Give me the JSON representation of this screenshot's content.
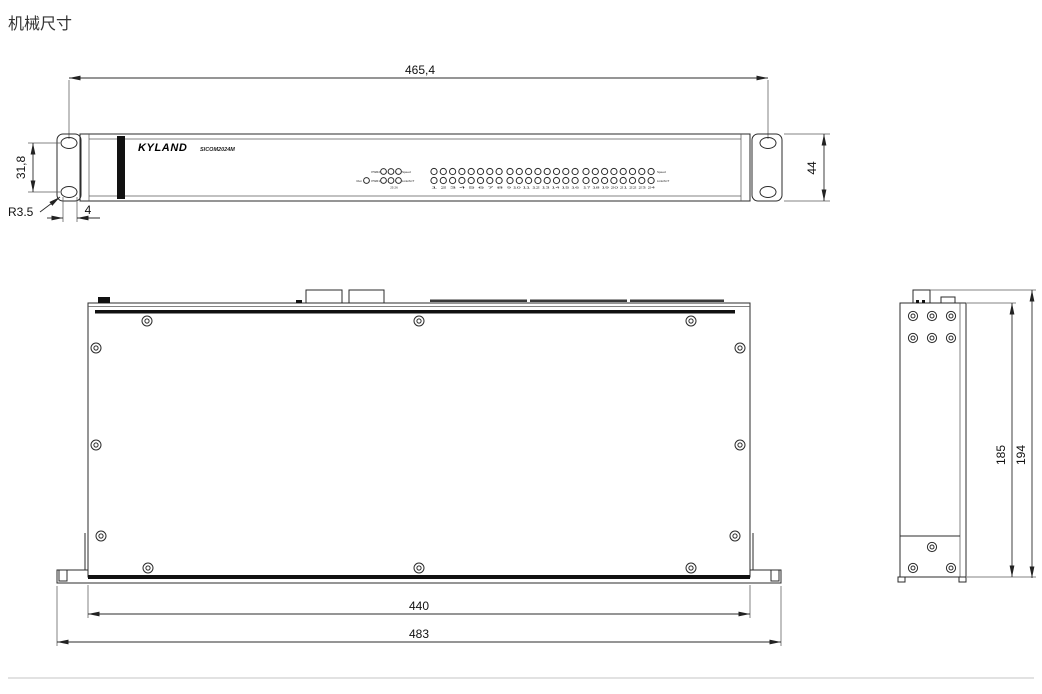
{
  "title": "机械尺寸",
  "front_panel": {
    "brand": "KYLAND",
    "model": "SICOM2024M",
    "status_leds": {
      "pwr2": "PWR2",
      "run": "Run",
      "pwr1": "PWR1",
      "speed": "Speed",
      "link_act": "Link/ACT",
      "port_numbers": "25 26"
    },
    "port_groups": [
      {
        "numbers": "1 2 3 4 5 6 7 8"
      },
      {
        "numbers": "9 10 11 12 13 14 15 16"
      },
      {
        "numbers": "17 18 19 20 21 22 23 24"
      }
    ],
    "port_led_labels": {
      "speed": "Speed",
      "link_act": "Link/ACT"
    }
  },
  "dimensions": {
    "front_width": "465,4",
    "front_height": "44",
    "ear_hole_spacing": "31,8",
    "ear_hole_radius": "R3.5",
    "ear_hole_offset": "4",
    "body_width": "440",
    "overall_width": "483",
    "side_depth_inner": "185",
    "side_depth_outer": "194"
  }
}
